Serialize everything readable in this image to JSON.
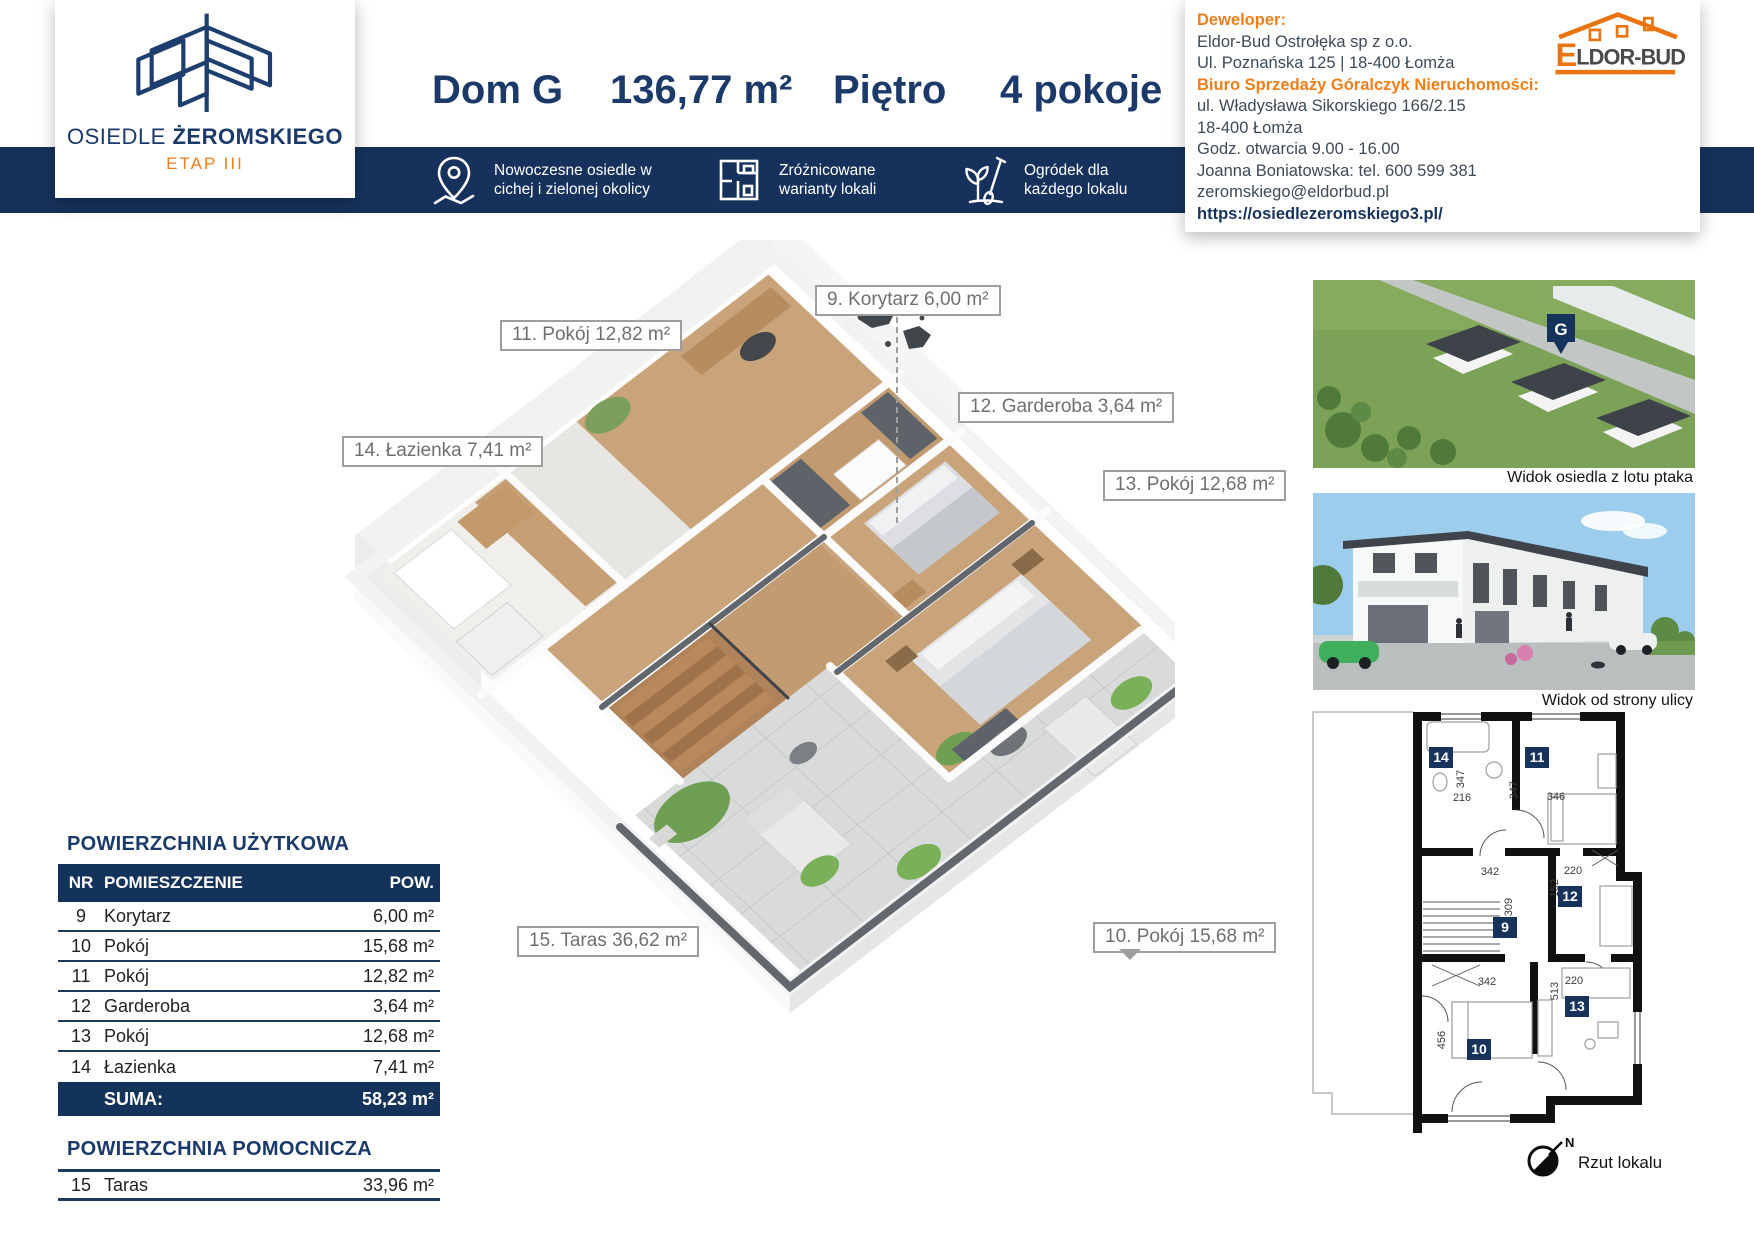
{
  "colors": {
    "navy": "#16325c",
    "orange": "#ef7e19",
    "label_gray": "#6f6f6f"
  },
  "logo_card": {
    "name_light": "OSIEDLE",
    "name_bold": "ŻEROMSKIEGO",
    "etap": "ETAP III"
  },
  "header": {
    "house": "Dom G",
    "area": "136,77 m²",
    "floor": "Piętro",
    "rooms": "4 pokoje"
  },
  "features": [
    {
      "icon": "map-pin-icon",
      "line1": "Nowoczesne osiedle w",
      "line2": "cichej i zielonej okolicy"
    },
    {
      "icon": "floorplan-icon",
      "line1": "Zróżnicowane",
      "line2": "warianty lokali"
    },
    {
      "icon": "garden-icon",
      "line1": "Ogródek dla",
      "line2": "każdego lokalu"
    }
  ],
  "developer": {
    "label": "Deweloper:",
    "company": "Eldor-Bud Ostrołęka sp z o.o.",
    "address": "Ul. Poznańska 125 | 18-400 Łomża",
    "office_label": "Biuro Sprzedaży Góralczyk Nieruchomości:",
    "office_address1": "ul. Władysława Sikorskiego 166/2.15",
    "office_address2": "18-400 Łomża",
    "hours": "Godz. otwarcia 9.00 - 16.00",
    "contact": "Joanna Boniatowska: tel. 600 599 381",
    "email": "zeromskiego@eldorbud.pl",
    "url": "https://osiedlezeromskiego3.pl/",
    "logo_e": "E",
    "logo_rest": "LDOR-BUD"
  },
  "plan3d": {
    "labels": [
      {
        "text": "9. Korytarz 6,00 m²"
      },
      {
        "text": "11. Pokój 12,82 m²"
      },
      {
        "text": "12. Garderoba 3,64 m²"
      },
      {
        "text": "14. Łazienka 7,41 m²"
      },
      {
        "text": "13. Pokój 12,68 m²"
      },
      {
        "text": "10. Pokój 15,68 m²"
      },
      {
        "text": "15. Taras 36,62 m²"
      }
    ]
  },
  "area_table": {
    "title": "POWIERZCHNIA UŻYTKOWA",
    "col_nr": "NR",
    "col_room": "POMIESZCZENIE",
    "col_area": "POW.",
    "rows": [
      {
        "nr": "9",
        "name": "Korytarz",
        "area": "6,00 m²"
      },
      {
        "nr": "10",
        "name": "Pokój",
        "area": "15,68 m²"
      },
      {
        "nr": "11",
        "name": "Pokój",
        "area": "12,82 m²"
      },
      {
        "nr": "12",
        "name": "Garderoba",
        "area": "3,64 m²"
      },
      {
        "nr": "13",
        "name": "Pokój",
        "area": "12,68 m²"
      },
      {
        "nr": "14",
        "name": "Łazienka",
        "area": "7,41 m²"
      }
    ],
    "sum_label": "SUMA:",
    "sum_value": "58,23 m²",
    "aux_title": "POWIERZCHNIA POMOCNICZA",
    "aux_row": {
      "nr": "15",
      "name": "Taras",
      "area": "33,96 m²"
    }
  },
  "photos": {
    "caption1": "Widok osiedla z lotu ptaka",
    "caption2": "Widok od strony ulicy",
    "pin_label": "G"
  },
  "plan2d": {
    "badges": [
      {
        "n": "14"
      },
      {
        "n": "11"
      },
      {
        "n": "12"
      },
      {
        "n": "9"
      },
      {
        "n": "13"
      },
      {
        "n": "10"
      }
    ],
    "dims": [
      {
        "v": "216"
      },
      {
        "v": "347"
      },
      {
        "v": "347"
      },
      {
        "v": "346"
      },
      {
        "v": "342"
      },
      {
        "v": "220"
      },
      {
        "v": "152"
      },
      {
        "v": "309"
      },
      {
        "v": "513"
      },
      {
        "v": "342"
      },
      {
        "v": "220"
      },
      {
        "v": "456"
      }
    ],
    "compass_n": "N",
    "caption": "Rzut lokalu"
  }
}
